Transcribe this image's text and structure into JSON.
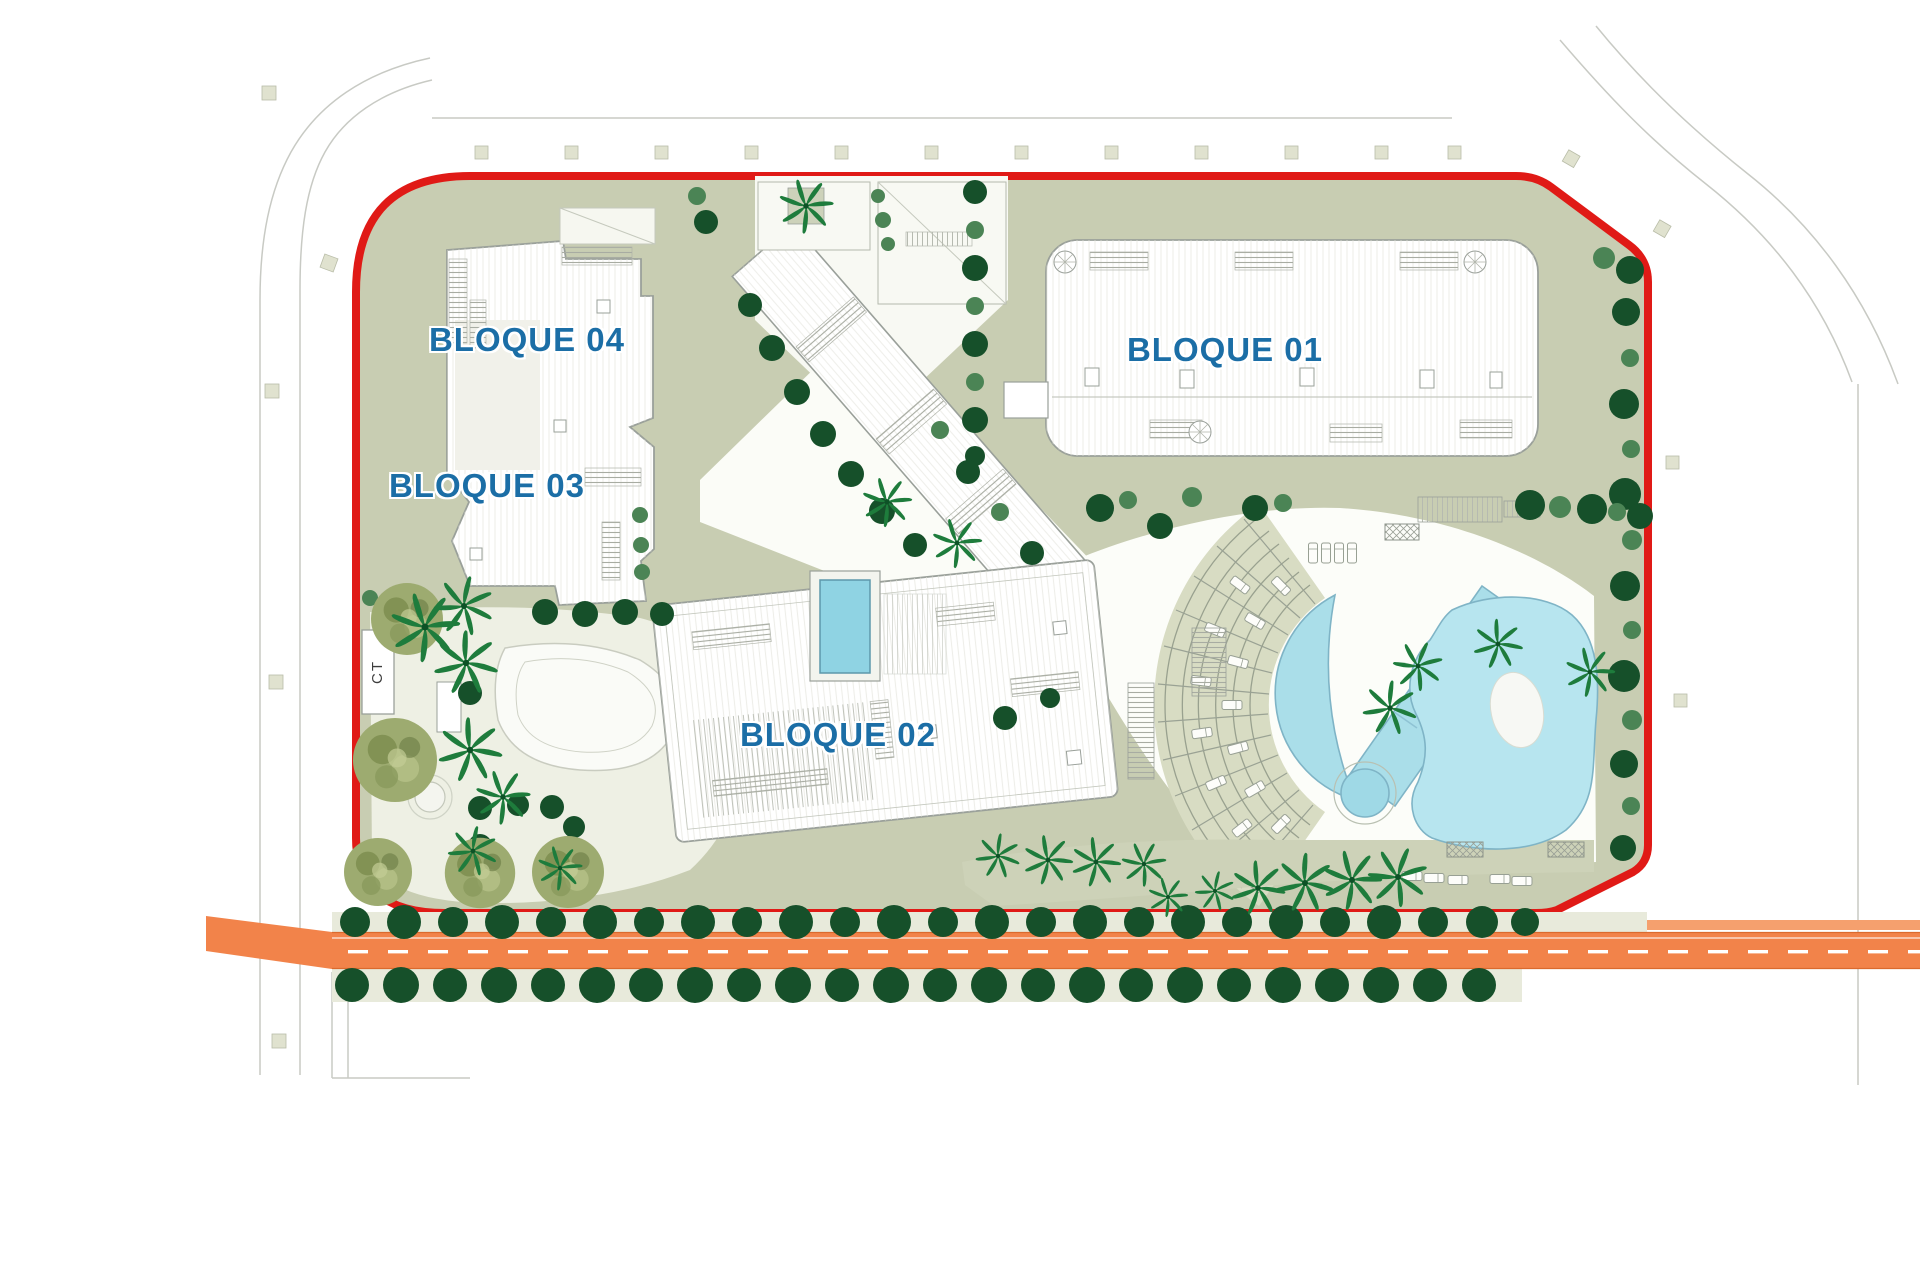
{
  "site_plan": {
    "type": "residential-masterplan",
    "labels": {
      "block_01": "BLOQUE 01",
      "block_02": "BLOQUE 02",
      "block_03": "BLOQUE 03",
      "block_04": "BLOQUE 04",
      "ct_box": "CT"
    },
    "colors": {
      "boundary_red": "#e01a16",
      "label_blue": "#1b6ea6",
      "road_orange": "#f2834a",
      "pool_blue": "#aadee9",
      "sage_green": "#c8cdb2",
      "tree_dark_green": "#16502a",
      "tree_light_green": "#4b8455",
      "palm_green": "#1e7c3c",
      "olive_green": "#9dab70",
      "ground_beige": "#e8eadb"
    }
  }
}
